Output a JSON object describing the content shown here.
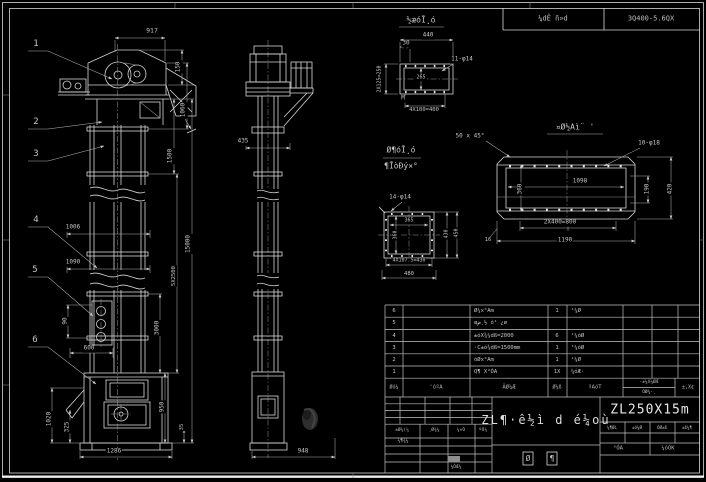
{
  "top_strip": {
    "cell1": "¼dÊ ñ»d",
    "cell2": "3Q400-5.6QX"
  },
  "annotations": [
    {
      "t": "917",
      "x": 152,
      "y": 31,
      "fs": 6.5
    },
    {
      "t": "150",
      "x": 179,
      "y": 67,
      "r": -90,
      "fs": 6
    },
    {
      "t": "1060",
      "x": 184,
      "y": 110,
      "r": -90,
      "fs": 6
    },
    {
      "t": "1500",
      "x": 171,
      "y": 156,
      "r": -90,
      "fs": 6
    },
    {
      "t": "15000",
      "x": 189,
      "y": 244,
      "r": -90,
      "fs": 6
    },
    {
      "t": "5X2500",
      "x": 174,
      "y": 276,
      "r": -90,
      "fs": 5.5
    },
    {
      "t": "1006",
      "x": 73,
      "y": 228,
      "fs": 6
    },
    {
      "t": "1090",
      "x": 73,
      "y": 263,
      "fs": 6
    },
    {
      "t": "90",
      "x": 66,
      "y": 321,
      "r": -90,
      "fs": 6
    },
    {
      "t": "600",
      "x": 89,
      "y": 349,
      "fs": 6
    },
    {
      "t": "3000",
      "x": 158,
      "y": 328,
      "r": -90,
      "fs": 6
    },
    {
      "t": "950",
      "x": 163,
      "y": 407,
      "r": -90,
      "fs": 6
    },
    {
      "t": "1020",
      "x": 50,
      "y": 419,
      "r": -90,
      "fs": 6
    },
    {
      "t": "325",
      "x": 68,
      "y": 427,
      "r": -90,
      "fs": 6
    },
    {
      "t": "35",
      "x": 182,
      "y": 427,
      "r": -90,
      "fs": 5.5
    },
    {
      "t": "1286",
      "x": 114,
      "y": 452,
      "fs": 6
    },
    {
      "t": "435",
      "x": 243,
      "y": 142,
      "fs": 6
    },
    {
      "t": "948",
      "x": 303,
      "y": 452,
      "fs": 6
    },
    {
      "t": "½æóĪ¸ó",
      "x": 421,
      "y": 21,
      "fs": 8,
      "n": "detail-a-title"
    },
    {
      "t": "440",
      "x": 428,
      "y": 36,
      "fs": 6
    },
    {
      "t": "30",
      "x": 406,
      "y": 44,
      "fs": 6
    },
    {
      "t": "11-φ14",
      "x": 462,
      "y": 60,
      "fs": 6,
      "n": "holes-callout-11"
    },
    {
      "t": "2X125=250",
      "x": 380,
      "y": 79,
      "r": -90,
      "fs": 5
    },
    {
      "t": "265",
      "x": 421,
      "y": 78,
      "fs": 5
    },
    {
      "t": "M",
      "x": 403,
      "y": 99,
      "fs": 6
    },
    {
      "t": "4X100=400",
      "x": 424,
      "y": 110,
      "fs": 5.5
    },
    {
      "t": "¤Ø½Aì¨ '",
      "x": 575,
      "y": 128,
      "fs": 8,
      "n": "detail-b-title"
    },
    {
      "t": "50 x 45°",
      "x": 470,
      "y": 137,
      "fs": 6
    },
    {
      "t": "10-φ18",
      "x": 649,
      "y": 144,
      "fs": 6,
      "n": "holes-callout-10"
    },
    {
      "t": "1098",
      "x": 580,
      "y": 182,
      "fs": 6
    },
    {
      "t": "360",
      "x": 521,
      "y": 189,
      "r": -90,
      "fs": 6
    },
    {
      "t": "190",
      "x": 648,
      "y": 189,
      "r": -90,
      "fs": 6
    },
    {
      "t": "420",
      "x": 671,
      "y": 189,
      "r": -90,
      "fs": 6
    },
    {
      "t": "2X400=800",
      "x": 560,
      "y": 223,
      "fs": 6
    },
    {
      "t": "1190",
      "x": 565,
      "y": 241,
      "fs": 6
    },
    {
      "t": "16",
      "x": 488,
      "y": 240,
      "fs": 5.5
    },
    {
      "t": "Ø¶óĪ¸ó",
      "x": 401,
      "y": 151,
      "fs": 8,
      "n": "detail-c-title"
    },
    {
      "t": "¶ĪòĐý×°",
      "x": 401,
      "y": 167,
      "fs": 8,
      "n": "detail-c-subtitle"
    },
    {
      "t": "14-φ14",
      "x": 400,
      "y": 198,
      "fs": 6,
      "n": "holes-callout-14"
    },
    {
      "t": "365",
      "x": 409,
      "y": 221,
      "fs": 5
    },
    {
      "t": "360",
      "x": 396,
      "y": 235,
      "r": -90,
      "fs": 5
    },
    {
      "t": "430",
      "x": 447,
      "y": 234,
      "r": -90,
      "fs": 5
    },
    {
      "t": "450",
      "x": 457,
      "y": 233,
      "r": -90,
      "fs": 5
    },
    {
      "t": "4X107.5=430",
      "x": 409,
      "y": 261,
      "fs": 5
    },
    {
      "t": "480",
      "x": 409,
      "y": 274,
      "fs": 5.5
    },
    {
      "t": "1",
      "x": 36,
      "y": 45,
      "fs": 9,
      "n": "balloon-1"
    },
    {
      "t": "2",
      "x": 36,
      "y": 123,
      "fs": 9,
      "n": "balloon-2"
    },
    {
      "t": "3",
      "x": 36,
      "y": 155,
      "fs": 9,
      "n": "balloon-3"
    },
    {
      "t": "4",
      "x": 36,
      "y": 221,
      "fs": 9,
      "n": "balloon-4"
    },
    {
      "t": "5",
      "x": 35,
      "y": 271,
      "fs": 9,
      "n": "balloon-5"
    },
    {
      "t": "6",
      "x": 35,
      "y": 341,
      "fs": 9,
      "n": "balloon-6"
    }
  ],
  "bom": {
    "header": {
      "seq": "Øó¼",
      "code": "'óºA",
      "name": "ÃØ¼Æ",
      "qty": "Ø¼ß",
      "material": "ªAóT",
      "weight_top": "·±¼X¼ØÆ",
      "weight_bottom": "ÓØ¾·¸",
      "remark": "±,X¢"
    },
    "rows": [
      {
        "no": "6",
        "name": "Ø¼x°Am",
        "qty": "1",
        "mat": "¹¼Ø"
      },
      {
        "no": "5",
        "name": "øض¸½ ó¹ ¿ø",
        "qty": "",
        "mat": ""
      },
      {
        "no": "4",
        "name": "±óX¾¼dß=2000",
        "qty": "6",
        "mat": "¹¼óØ"
      },
      {
        "no": "3",
        "name": "·C±ó¾dß=1500mm",
        "qty": "1",
        "mat": "¹¼óØ"
      },
      {
        "no": "2",
        "name": "óØx°Am",
        "qty": "1",
        "mat": "¹¼Ø"
      },
      {
        "no": "1",
        "name": "Q¶ X°ÓA",
        "qty": "1X",
        "mat": "¼óÆ·"
      }
    ]
  },
  "titleblock": {
    "left": {
      "header": [
        "±Ø¼(¼",
        "¸Ø¾¼",
        "¼×Ó",
        "ºÓ¼"
      ],
      "row2": "¼¶¾¼",
      "bottom": "¼ÓÆ¼"
    },
    "title": "ZL¶·ê½ì d é¼où",
    "stage": [
      "Ø",
      "¶"
    ],
    "code": "ZL250X15m",
    "small_headers": [
      "¼¶ØL",
      "±ó¼Ø",
      "ÓØ±ß",
      "±ß¼¶"
    ],
    "sheets_left": "°ÓA",
    "sheets_right": "¼óÓK"
  }
}
